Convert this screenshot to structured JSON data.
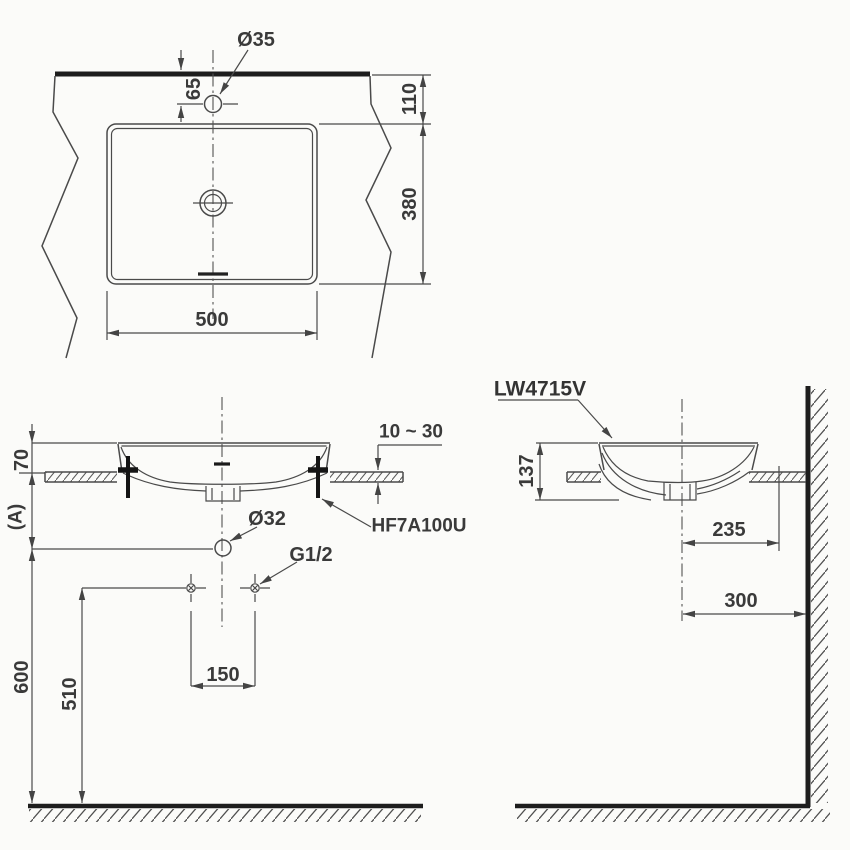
{
  "drawing": {
    "product_code": "LW4715V",
    "colors": {
      "background": "#fbfbf9",
      "line": "#4a4a4a",
      "heavy_line": "#1d1d1d",
      "text": "#3a3a3a"
    },
    "top_view": {
      "faucet_hole": "Ø35",
      "faucet_offset": "65",
      "ledge_depth": "110",
      "basin_depth": "380",
      "basin_width": "500"
    },
    "front_view": {
      "rim_height": "70",
      "counter_to_drain": "(A)",
      "counter_thickness": "10 ~ 30",
      "drain_hole": "Ø32",
      "mounting_kit": "HF7A100U",
      "supply_thread": "G1/2",
      "supply_spacing": "150",
      "supply_height": "510",
      "drain_height": "600"
    },
    "side_view": {
      "model_label": "LW4715V",
      "basin_height": "137",
      "drain_to_wall": "235",
      "center_to_wall": "300"
    }
  }
}
